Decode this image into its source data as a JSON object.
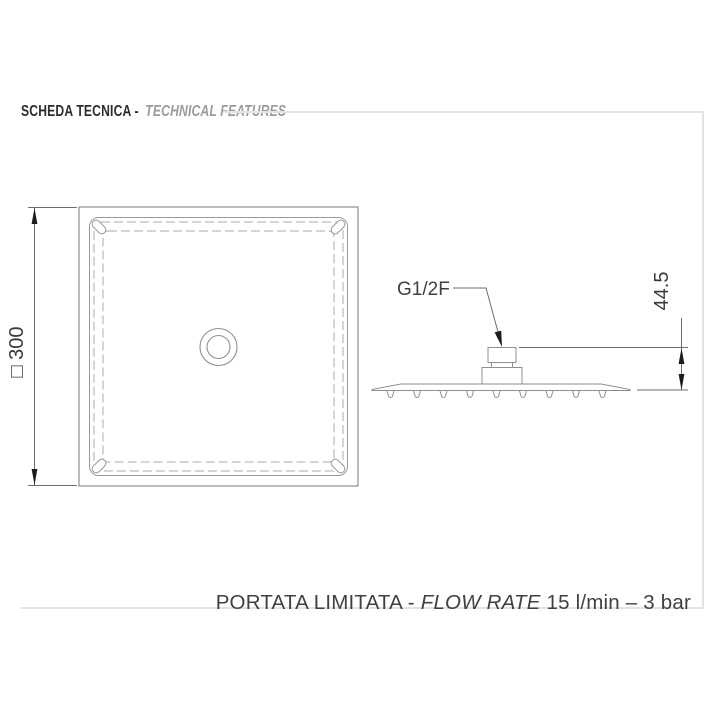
{
  "header": {
    "title_italian": "SCHEDA TECNICA - ",
    "title_english": "TECHNICAL FEATURES"
  },
  "top_view": {
    "description": "square shower head, top view",
    "dimension_label": "□ 300"
  },
  "side_view": {
    "description": "shower head profile with threaded water connection",
    "connection_label": "G1/2F",
    "height_label": "44.5"
  },
  "footer": {
    "limited_flow_italian": "PORTATA LIMITATA - ",
    "flow_rate_english": "FLOW RATE",
    "flow_value": " 15 l/min – 3 bar"
  },
  "colors": {
    "background": "#ffffff",
    "frame_gray": "#e3e3e3",
    "drawing_line": "#8f8f8f",
    "dashed_line": "#a9a9a9",
    "dimension_line": "#6e6e6e",
    "arrow_black": "#1c1c1c",
    "text_dark": "#3f4042",
    "header_dark": "#2d2d2f",
    "header_gray": "#9a9b9d"
  }
}
